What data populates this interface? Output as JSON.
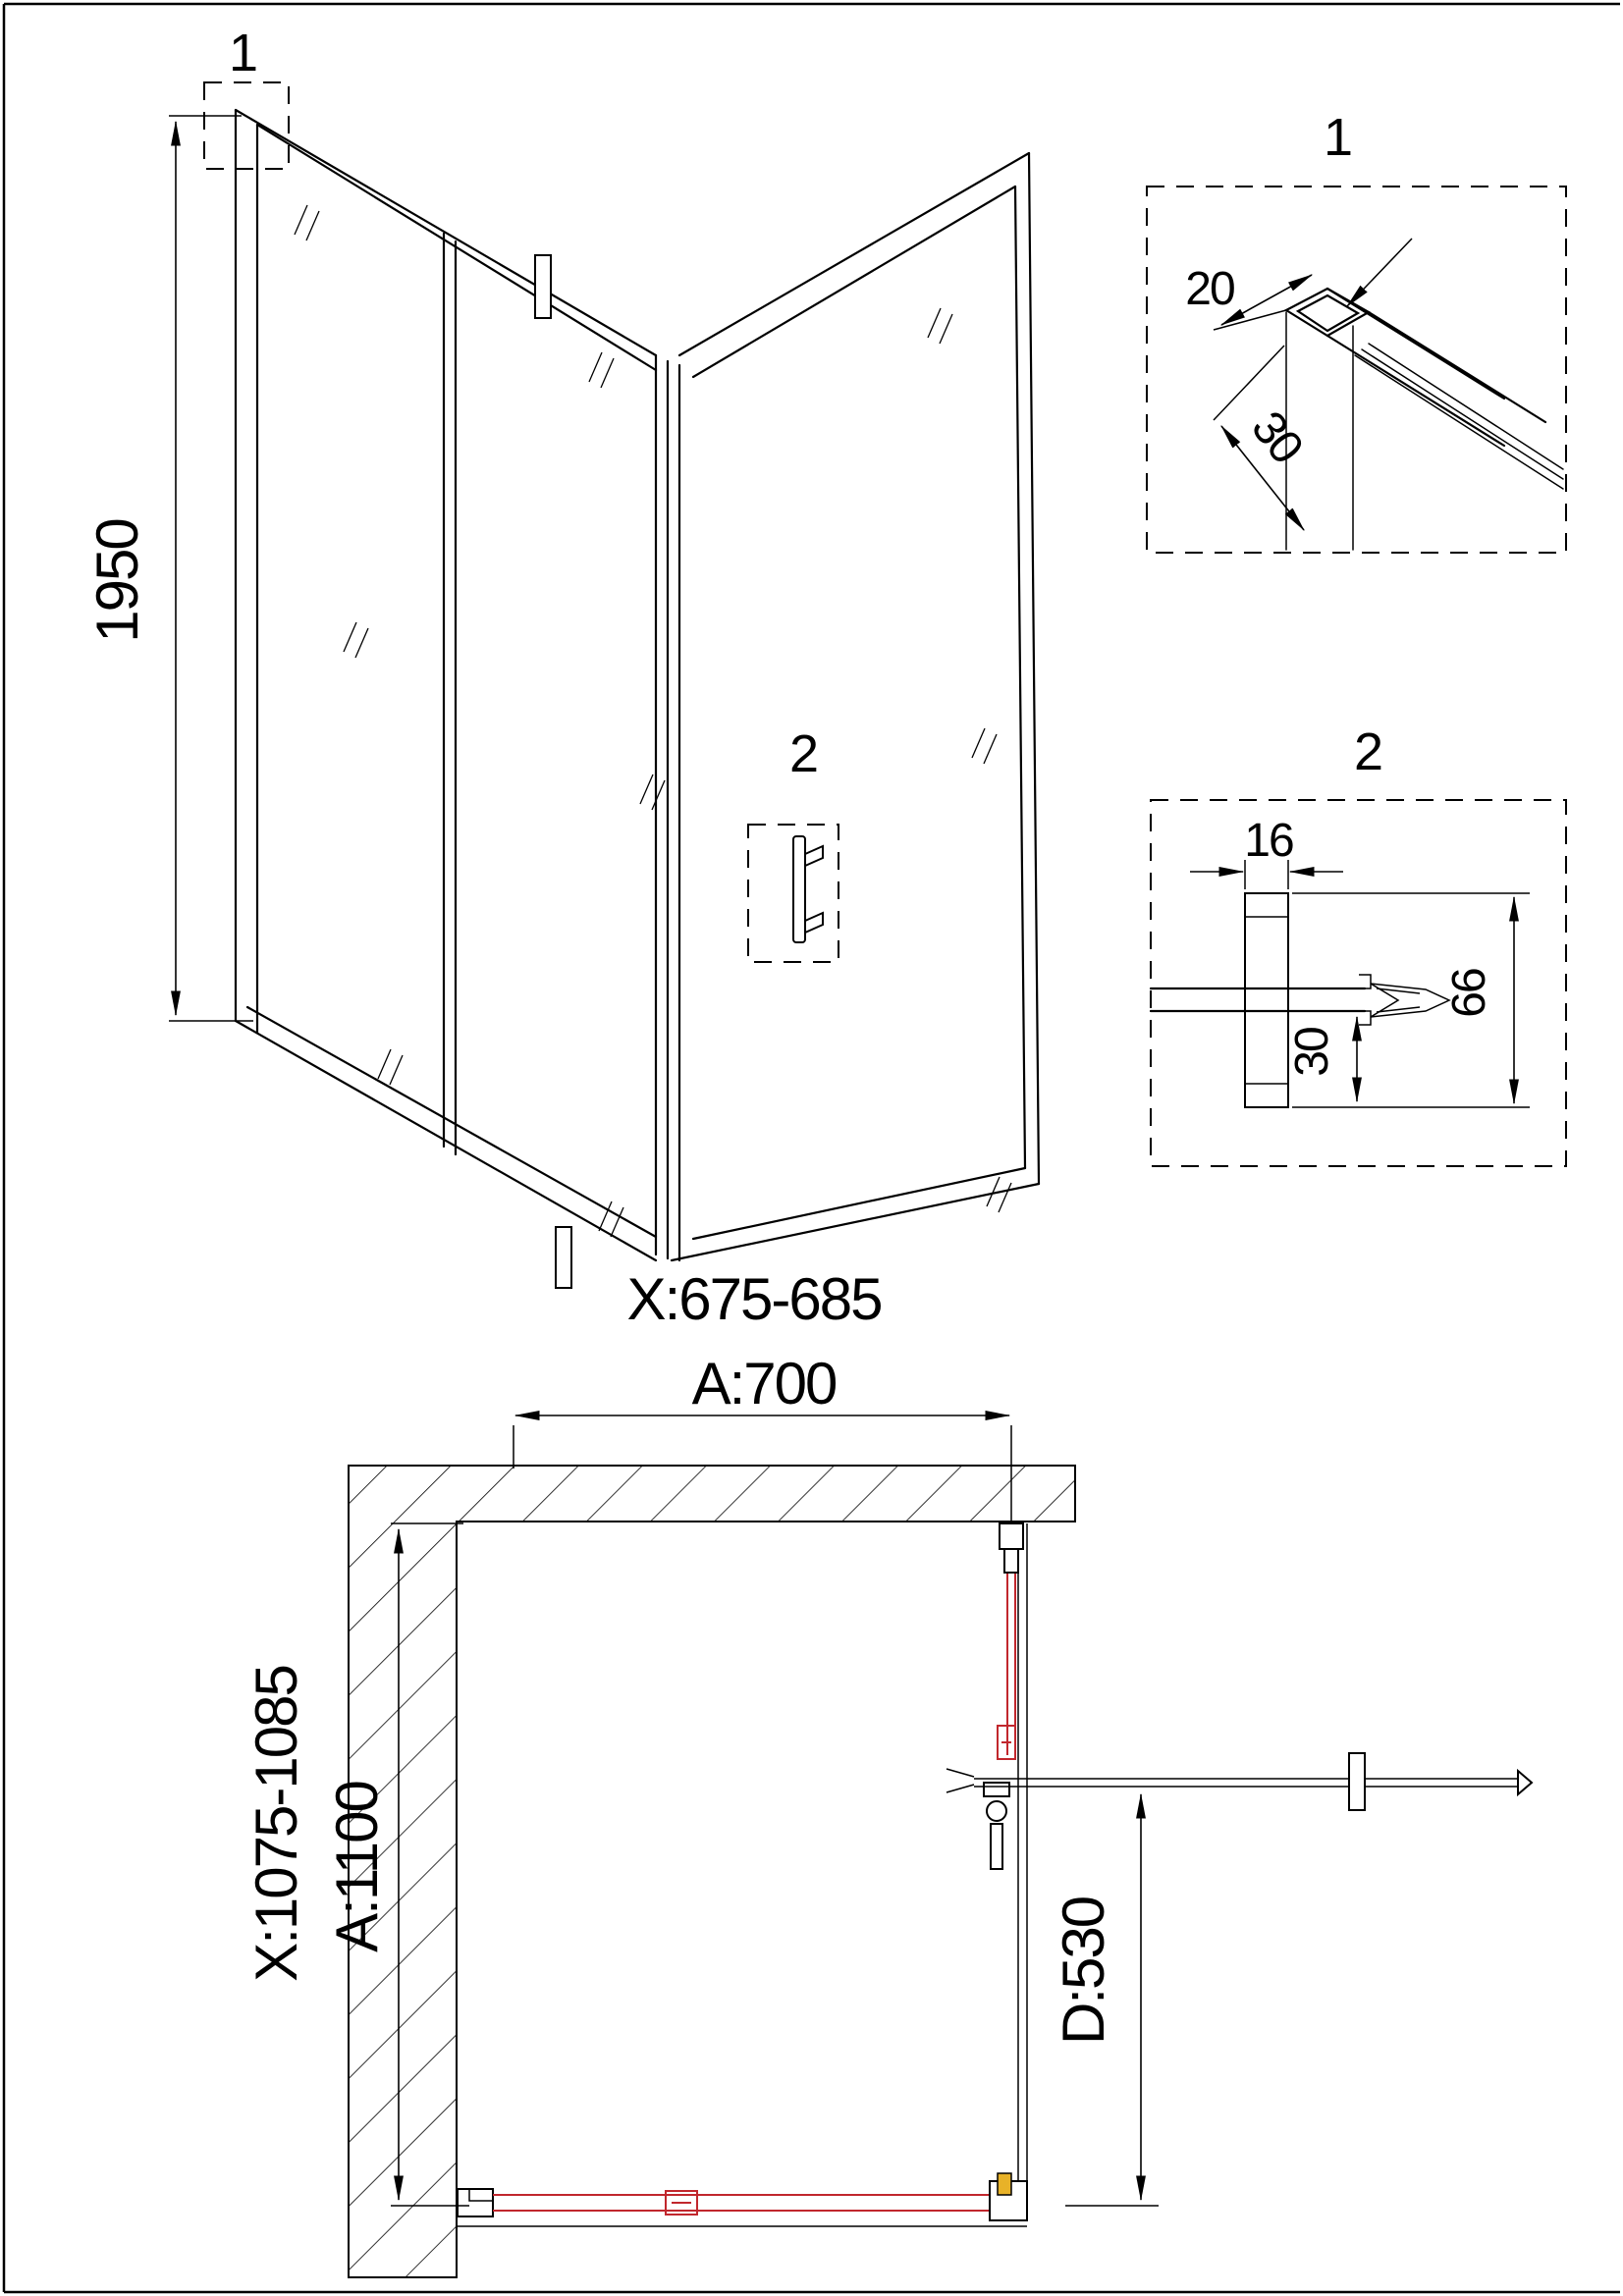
{
  "colors": {
    "line": "#000000",
    "glass_red": "#c1272d",
    "accent_yellow": "#e8b228"
  },
  "iso_view": {
    "callout_1": "1",
    "callout_2": "2",
    "height_dim": "1950",
    "width_range": "X:675-685",
    "width_dim": "A:700"
  },
  "detail_1": {
    "label": "1",
    "dim_width": "20",
    "dim_depth": "30"
  },
  "detail_2": {
    "label": "2",
    "dim_profile_width": "16",
    "dim_glass_inset": "30",
    "dim_profile_height": "66"
  },
  "plan_view": {
    "depth_range": "X:1075-1085",
    "depth_dim": "A:1100",
    "door_width_dim": "D:530"
  }
}
